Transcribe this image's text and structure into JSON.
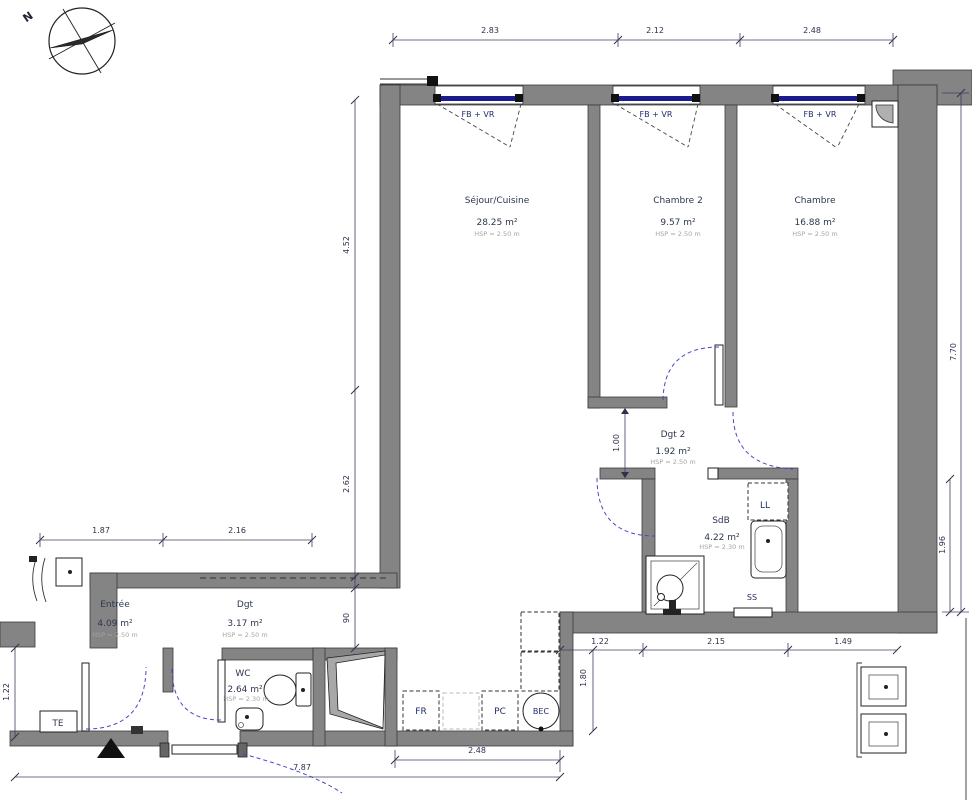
{
  "compass": {
    "north": "N"
  },
  "windows": {
    "label": "FB + VR"
  },
  "rooms": {
    "sejour": {
      "name": "Séjour/Cuisine",
      "area": "28.25 m²",
      "hsp": "HSP = 2.50 m"
    },
    "chambre2": {
      "name": "Chambre 2",
      "area": "9.57 m²",
      "hsp": "HSP = 2.50 m"
    },
    "chambre": {
      "name": "Chambre",
      "area": "16.88 m²",
      "hsp": "HSP = 2.50 m"
    },
    "dgt2": {
      "name": "Dgt 2",
      "area": "1.92 m²",
      "hsp": "HSP = 2.50 m"
    },
    "sdb": {
      "name": "SdB",
      "area": "4.22 m²",
      "hsp": "HSP = 2.30 m"
    },
    "entree": {
      "name": "Entrée",
      "area": "4.09 m²",
      "hsp": "HSP = 2.50 m"
    },
    "dgt": {
      "name": "Dgt",
      "area": "3.17 m²",
      "hsp": "HSP = 2.50 m"
    },
    "wc": {
      "name": "WC",
      "area": "2.64 m²",
      "hsp": "HSP = 2.30 m"
    }
  },
  "equipment": {
    "ll": "LL",
    "ss": "SS",
    "te": "TE",
    "fr": "FR",
    "pc": "PC",
    "bec": "BEC"
  },
  "dimensions": {
    "top": {
      "a": "2.83",
      "b": "2.12",
      "c": "2.48"
    },
    "left": {
      "a": "4.52",
      "b": "2.62",
      "c": "90"
    },
    "left_lower": {
      "a": "1.87",
      "b": "2.16",
      "c": "1.22"
    },
    "right": {
      "a": "7.70",
      "b": "1.96"
    },
    "inner": {
      "passage": "1.00",
      "kitchen": "1.80",
      "a": "1.22",
      "b": "2.15",
      "c": "1.49"
    },
    "bottom": {
      "a": "2.48",
      "b": "7.87"
    }
  },
  "colors": {
    "wall": "#848484",
    "glazing": "#1b1b8e",
    "door_arc": "#4646c8",
    "label": "#2e3650"
  }
}
